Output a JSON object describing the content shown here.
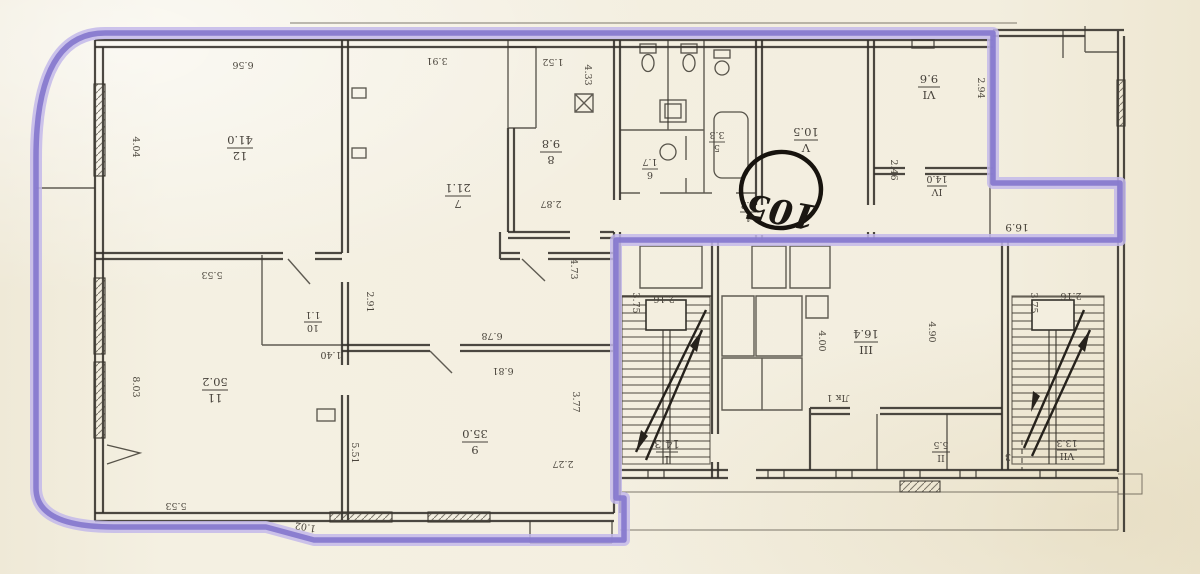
{
  "document": {
    "type": "scanned apartment floor plan (BTI drawing)",
    "highlight_color": "#8578cd",
    "paper_color": "#f3eedf",
    "ink_color": "#33302a"
  },
  "stamp": {
    "number": "105"
  },
  "rooms": [
    {
      "num": "12",
      "area": "41.0"
    },
    {
      "num": "7",
      "area": "21.1"
    },
    {
      "num": "8",
      "area": "9.8"
    },
    {
      "num": "11",
      "area": "50.2"
    },
    {
      "num": "10",
      "area": "1.1"
    },
    {
      "num": "9",
      "area": "35.0"
    },
    {
      "num": "V",
      "area": "10.5"
    },
    {
      "num": "VI",
      "area": "9.6"
    },
    {
      "num": "IV",
      "area": "14.0"
    },
    {
      "num": "I",
      "area": "14.3"
    },
    {
      "num": "III",
      "area": "16.4"
    },
    {
      "num": "II",
      "area": "5.5"
    },
    {
      "num": "VII",
      "area": "13.3"
    },
    {
      "num": "1",
      "area": "4.2"
    },
    {
      "num": "6",
      "area": "1.7"
    },
    {
      "num": "5",
      "area": "3.3"
    }
  ],
  "dims": [
    "6.56",
    "3.91",
    "1.52",
    "4.33",
    "4.04",
    "5.53",
    "2.91",
    "2.87",
    "4.73",
    "6.78",
    "6.81",
    "1.40",
    "8.03",
    "5.51",
    "3.77",
    "2.27",
    "5.53",
    "1.02",
    "16.9",
    "2.94",
    "2.46",
    "3.75",
    "2.16",
    "4.00",
    "4.90",
    "3.75",
    "2.16",
    "Лк 1",
    "3"
  ]
}
